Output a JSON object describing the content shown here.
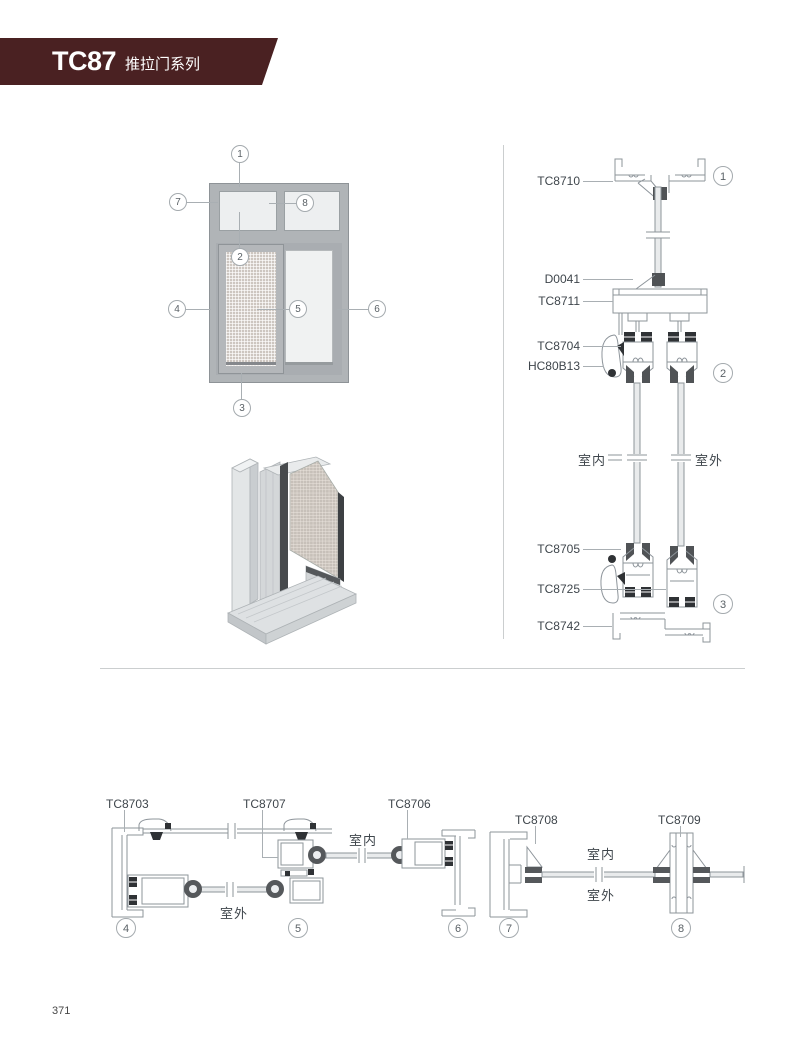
{
  "header": {
    "code": "TC87",
    "series": "推拉门系列"
  },
  "footer": {
    "page_number": "371"
  },
  "terms": {
    "indoor": "室内",
    "outdoor": "室外"
  },
  "colors": {
    "banner": "#4a2122",
    "drawing_line": "#8d949a",
    "gasket_dark": "#2f3235",
    "glass_fill": "#e9ebec",
    "frame_gray": "#b0b4b7"
  },
  "elevation": {
    "callouts": {
      "c1": "1",
      "c2": "2",
      "c3": "3",
      "c4": "4",
      "c5": "5",
      "c6": "6",
      "c7": "7",
      "c8": "8"
    }
  },
  "vertical_section": {
    "labels": {
      "top_frame": "TC8710",
      "glazing_clip": "D0041",
      "transom": "TC8711",
      "sash_top": "TC8704",
      "lock": "HC80B13",
      "sash_bottom": "TC8705",
      "interlock": "TC8725",
      "bottom_track": "TC8742"
    },
    "callouts": {
      "c1": "1",
      "c2": "2",
      "c3": "3"
    }
  },
  "horizontal_section": {
    "labels": {
      "left_jamb": "TC8703",
      "interlock": "TC8707",
      "sash": "TC8706",
      "fixed_jamb": "TC8708",
      "mullion": "TC8709"
    },
    "callouts": {
      "c4": "4",
      "c5": "5",
      "c6": "6",
      "c7": "7",
      "c8": "8"
    }
  }
}
